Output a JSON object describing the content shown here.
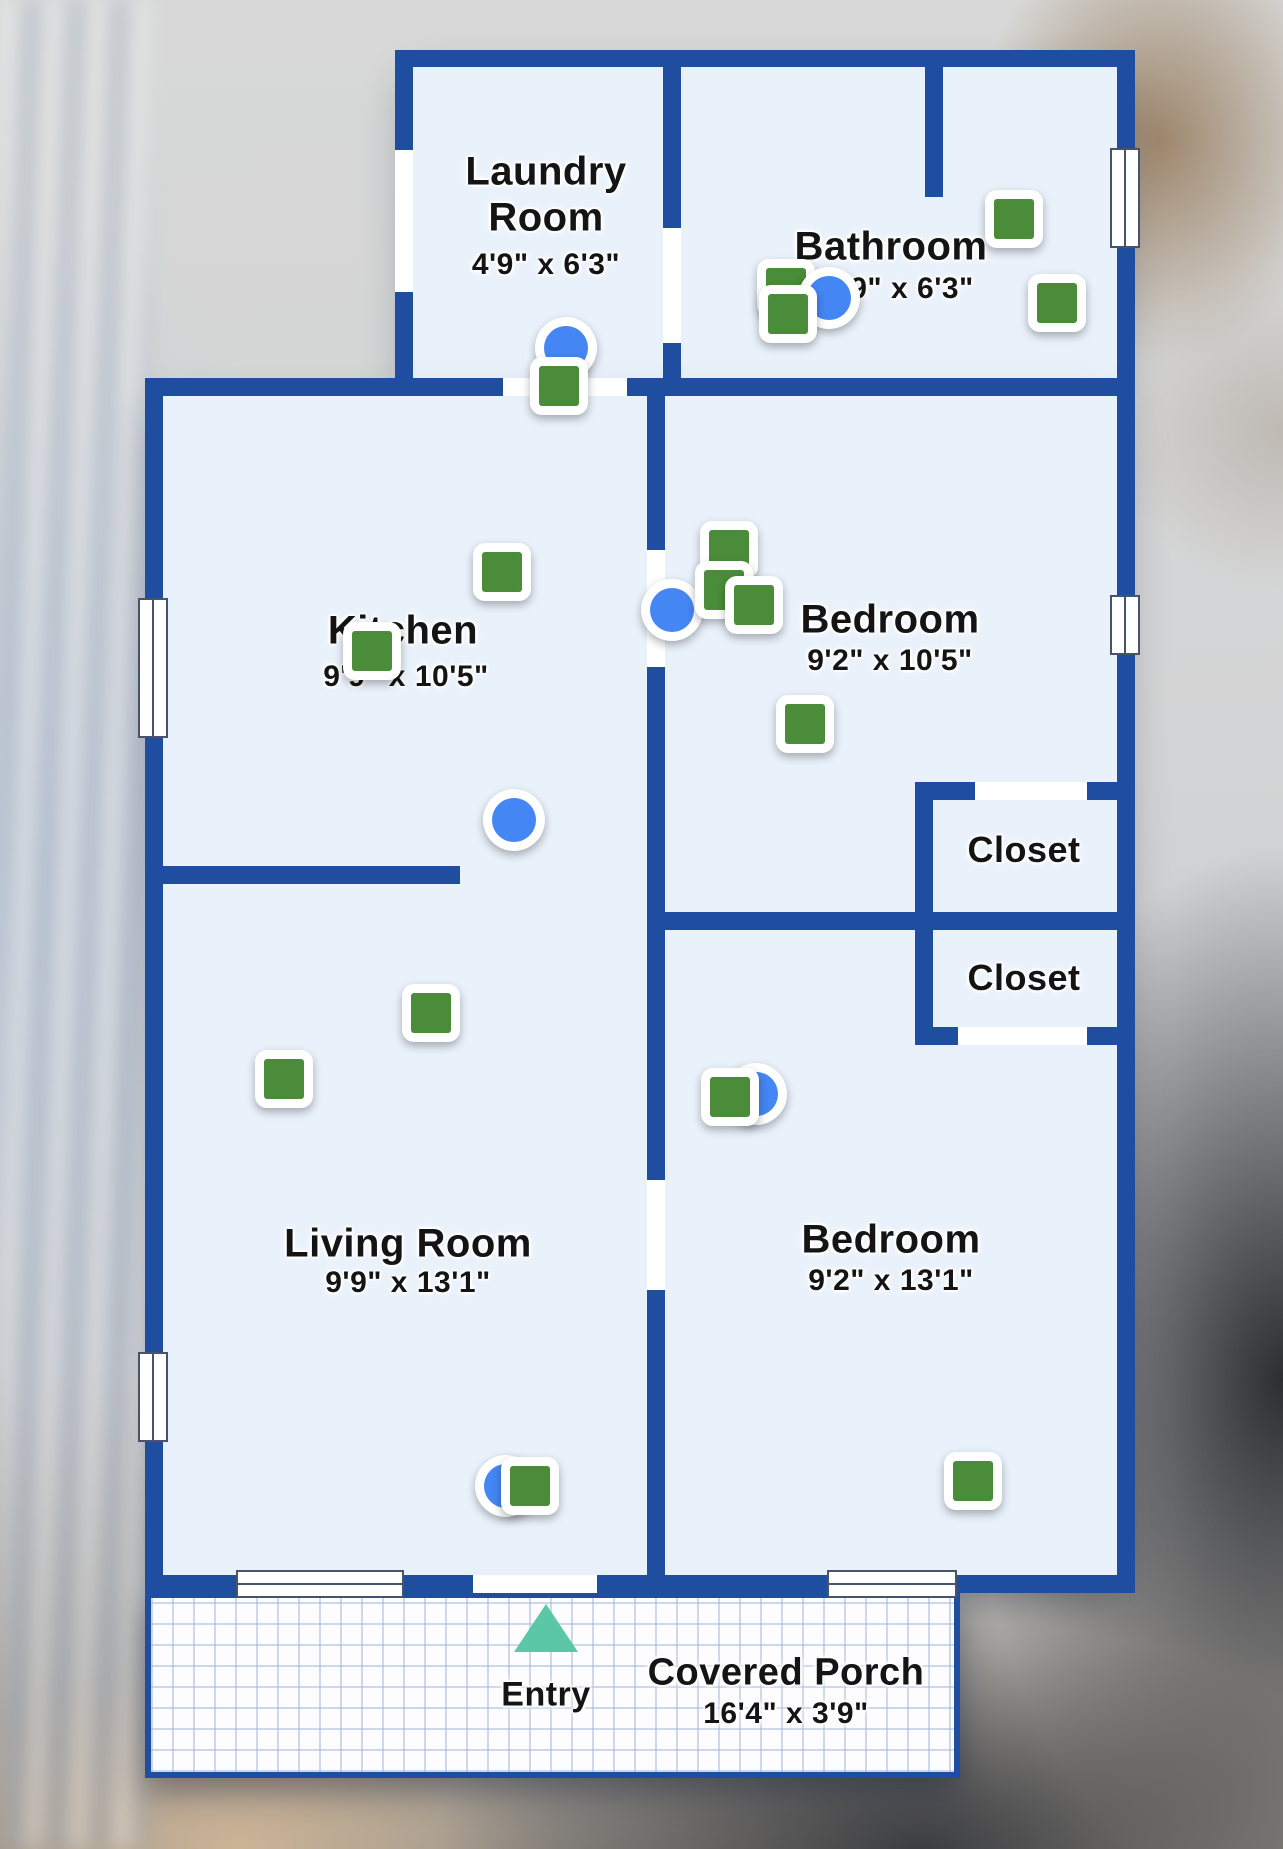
{
  "app": {
    "view_title": "Floor Plan",
    "colors": {
      "wall": "#1f4da0",
      "room_fill": "#e9f1fb",
      "door_gap": "#ffffff",
      "photo_marker_green": "#4a8c3a",
      "camera_marker_blue": "#4486f4",
      "entry_arrow_teal": "#5bc7a7",
      "label_text": "#141414"
    }
  },
  "floorplan": {
    "rooms": [
      {
        "name": "Laundry Room",
        "dimensions": "4'9\" x 6'3\"",
        "lines": [
          {
            "text": "Laundry",
            "x": 546,
            "y": 172,
            "size": 40
          },
          {
            "text": "Room",
            "x": 546,
            "y": 218,
            "size": 40
          },
          {
            "text": "4'9\" x 6'3\"",
            "x": 546,
            "y": 265,
            "size": 30
          }
        ]
      },
      {
        "name": "Bathroom",
        "dimensions": "9\" x 6'3\"",
        "lines": [
          {
            "text": "Bathroom",
            "x": 891,
            "y": 247,
            "size": 40
          },
          {
            "text": "9\" x 6'3\"",
            "x": 912,
            "y": 289,
            "size": 30
          }
        ]
      },
      {
        "name": "Kitchen",
        "dimensions": "9'9\" x 10'5\"",
        "lines": [
          {
            "text": "Kitchen",
            "x": 403,
            "y": 631,
            "size": 40
          },
          {
            "text": "9'9\" x 10'5\"",
            "x": 406,
            "y": 677,
            "size": 30
          }
        ]
      },
      {
        "name": "Bedroom",
        "dimensions": "9'2\" x 10'5\"",
        "lines": [
          {
            "text": "Bedroom",
            "x": 890,
            "y": 620,
            "size": 40
          },
          {
            "text": "9'2\" x 10'5\"",
            "x": 890,
            "y": 661,
            "size": 30
          }
        ]
      },
      {
        "name": "Closet",
        "dimensions": "",
        "lines": [
          {
            "text": "Closet",
            "x": 1024,
            "y": 850,
            "size": 36
          }
        ]
      },
      {
        "name": "Closet",
        "dimensions": "",
        "lines": [
          {
            "text": "Closet",
            "x": 1024,
            "y": 978,
            "size": 36
          }
        ]
      },
      {
        "name": "Living Room",
        "dimensions": "9'9\" x 13'1\"",
        "lines": [
          {
            "text": "Living Room",
            "x": 408,
            "y": 1244,
            "size": 40
          },
          {
            "text": "9'9\" x 13'1\"",
            "x": 408,
            "y": 1283,
            "size": 30
          }
        ]
      },
      {
        "name": "Bedroom",
        "dimensions": "9'2\" x 13'1\"",
        "lines": [
          {
            "text": "Bedroom",
            "x": 891,
            "y": 1240,
            "size": 40
          },
          {
            "text": "9'2\" x 13'1\"",
            "x": 891,
            "y": 1281,
            "size": 30
          }
        ]
      },
      {
        "name": "Covered Porch",
        "dimensions": "16'4\" x 3'9\"",
        "lines": [
          {
            "text": "Covered Porch",
            "x": 786,
            "y": 1673,
            "size": 38
          },
          {
            "text": "16'4\" x 3'9\"",
            "x": 786,
            "y": 1714,
            "size": 30
          }
        ]
      },
      {
        "name": "Entry",
        "dimensions": "",
        "lines": [
          {
            "text": "Entry",
            "x": 546,
            "y": 1695,
            "size": 34
          }
        ]
      }
    ],
    "blocks": [
      [
        413,
        67,
        704,
        311
      ],
      [
        163,
        396,
        954,
        1179
      ]
    ],
    "walls": [
      [
        395,
        50,
        740,
        17
      ],
      [
        395,
        67,
        18,
        83
      ],
      [
        395,
        292,
        18,
        104
      ],
      [
        663,
        67,
        18,
        161
      ],
      [
        663,
        343,
        18,
        53
      ],
      [
        925,
        67,
        18,
        130
      ],
      [
        1117,
        50,
        18,
        1543
      ],
      [
        145,
        378,
        358,
        18
      ],
      [
        627,
        378,
        508,
        18
      ],
      [
        145,
        396,
        18,
        1197
      ],
      [
        647,
        396,
        18,
        154
      ],
      [
        647,
        667,
        18,
        217
      ],
      [
        163,
        866,
        297,
        18
      ],
      [
        647,
        884,
        18,
        296
      ],
      [
        647,
        1290,
        18,
        303
      ],
      [
        915,
        782,
        220,
        18
      ],
      [
        915,
        800,
        18,
        112
      ],
      [
        647,
        912,
        488,
        18
      ],
      [
        915,
        930,
        18,
        115
      ],
      [
        915,
        1027,
        220,
        18
      ],
      [
        145,
        1575,
        990,
        18
      ]
    ],
    "door_gaps": [
      [
        395,
        150,
        18,
        142
      ],
      [
        503,
        378,
        124,
        18
      ],
      [
        663,
        228,
        18,
        115
      ],
      [
        647,
        550,
        18,
        117
      ],
      [
        647,
        1180,
        18,
        110
      ],
      [
        975,
        782,
        112,
        18
      ],
      [
        958,
        1027,
        129,
        18
      ],
      [
        473,
        1575,
        124,
        18
      ]
    ],
    "windows": [
      {
        "x": 1110,
        "y": 148,
        "w": 30,
        "h": 100,
        "o": "v"
      },
      {
        "x": 1110,
        "y": 595,
        "w": 30,
        "h": 60,
        "o": "v"
      },
      {
        "x": 138,
        "y": 598,
        "w": 30,
        "h": 140,
        "o": "v"
      },
      {
        "x": 138,
        "y": 1352,
        "w": 30,
        "h": 90,
        "o": "v"
      },
      {
        "x": 236,
        "y": 1570,
        "w": 168,
        "h": 28,
        "o": "h"
      },
      {
        "x": 827,
        "y": 1570,
        "w": 130,
        "h": 28,
        "o": "h"
      }
    ],
    "porch": {
      "x": 145,
      "y": 1592,
      "w": 815,
      "h": 186
    },
    "entry_arrow": {
      "x": 546,
      "y": 1604
    },
    "markers": [
      {
        "kind": "camera",
        "x": 566,
        "y": 348
      },
      {
        "kind": "photo",
        "x": 559,
        "y": 386
      },
      {
        "kind": "photo",
        "x": 786,
        "y": 288
      },
      {
        "kind": "camera",
        "x": 829,
        "y": 298
      },
      {
        "kind": "photo",
        "x": 788,
        "y": 314
      },
      {
        "kind": "photo",
        "x": 1014,
        "y": 219
      },
      {
        "kind": "photo",
        "x": 1057,
        "y": 303
      },
      {
        "kind": "photo",
        "x": 502,
        "y": 572
      },
      {
        "kind": "photo",
        "x": 372,
        "y": 651
      },
      {
        "kind": "camera",
        "x": 514,
        "y": 820
      },
      {
        "kind": "camera",
        "x": 672,
        "y": 610
      },
      {
        "kind": "photo",
        "x": 729,
        "y": 550
      },
      {
        "kind": "photo",
        "x": 724,
        "y": 590
      },
      {
        "kind": "photo",
        "x": 754,
        "y": 605
      },
      {
        "kind": "photo",
        "x": 805,
        "y": 724
      },
      {
        "kind": "camera",
        "x": 756,
        "y": 1094
      },
      {
        "kind": "photo",
        "x": 730,
        "y": 1097
      },
      {
        "kind": "camera",
        "x": 506,
        "y": 1486
      },
      {
        "kind": "photo",
        "x": 530,
        "y": 1486
      },
      {
        "kind": "photo",
        "x": 431,
        "y": 1013
      },
      {
        "kind": "photo",
        "x": 284,
        "y": 1079
      },
      {
        "kind": "photo",
        "x": 973,
        "y": 1481
      }
    ]
  }
}
